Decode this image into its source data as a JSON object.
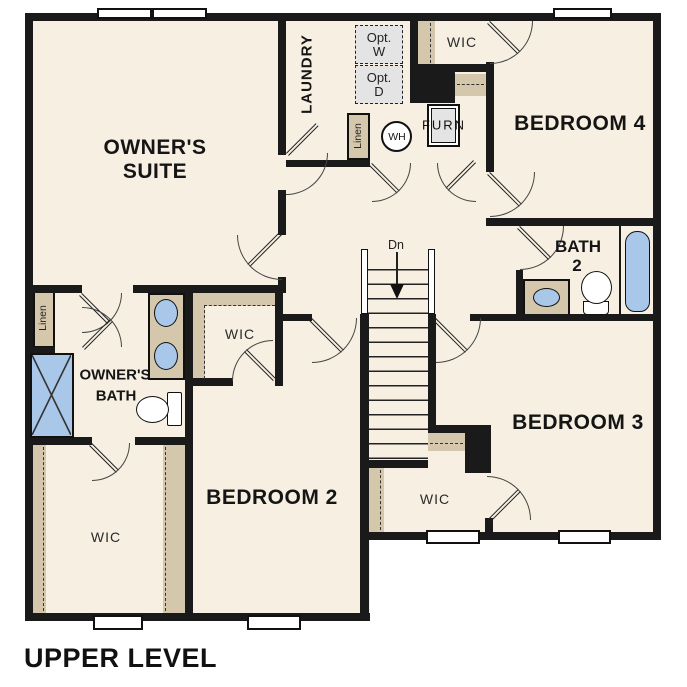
{
  "title": "UPPER LEVEL",
  "colors": {
    "floor": "#f6efe2",
    "closet_tan": "#d5c7ac",
    "fixture_blue": "#a9c7e9",
    "appliance_gray": "#e4e4e4",
    "wall": "#1a1a1a"
  },
  "rooms": {
    "owners_suite": {
      "label_line1": "OWNER'S",
      "label_line2": "SUITE"
    },
    "laundry": {
      "label": "LAUNDRY"
    },
    "bedroom4": {
      "label": "BEDROOM 4"
    },
    "bath2": {
      "label_line1": "BATH",
      "label_line2": "2"
    },
    "bedroom3": {
      "label": "BEDROOM 3"
    },
    "bedroom2": {
      "label": "BEDROOM 2"
    },
    "owners_bath": {
      "label_line1": "OWNER'S",
      "label_line2": "BATH"
    },
    "wic_bedroom4": {
      "label": "WIC"
    },
    "wic_owners": {
      "label": "WIC"
    },
    "wic_lower_left": {
      "label": "WIC"
    },
    "wic_bedroom3": {
      "label": "WIC"
    }
  },
  "closets": {
    "linen_laundry": "Linen",
    "linen_owners": "Linen"
  },
  "appliances": {
    "opt_washer_line1": "Opt.",
    "opt_washer_line2": "W",
    "opt_dryer_line1": "Opt.",
    "opt_dryer_line2": "D",
    "water_heater": "WH",
    "furnace": "FURN"
  },
  "stairs": {
    "direction_label": "Dn"
  }
}
